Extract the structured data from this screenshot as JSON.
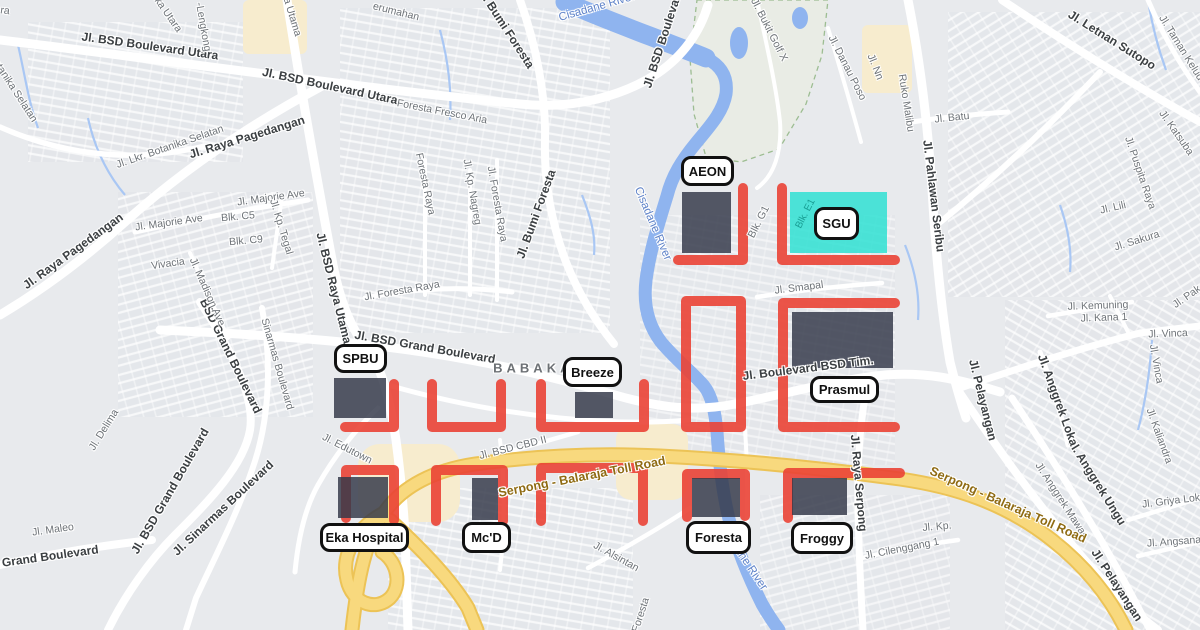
{
  "colors": {
    "annotation_red": "#EA4335",
    "building_fill": "rgba(52,57,74,0.84)",
    "highlight_cyan": "rgba(47,224,210,0.85)",
    "water": "#8FB4EF",
    "toll_road_fill": "#F8D97E",
    "map_background": "#E8EAED",
    "marker_bg": "#FFFFFF",
    "marker_border": "#111111"
  },
  "markers": [
    {
      "id": "aeon",
      "label": "AEON",
      "x": 681,
      "y": 156,
      "w": 53,
      "h": 30
    },
    {
      "id": "sgu",
      "label": "SGU",
      "x": 814,
      "y": 207,
      "w": 45,
      "h": 33
    },
    {
      "id": "spbu",
      "label": "SPBU",
      "x": 334,
      "y": 344,
      "w": 53,
      "h": 29
    },
    {
      "id": "breeze",
      "label": "Breeze",
      "x": 563,
      "y": 357,
      "w": 59,
      "h": 30
    },
    {
      "id": "prasmul",
      "label": "Prasmul",
      "x": 810,
      "y": 376,
      "w": 69,
      "h": 27
    },
    {
      "id": "eka-hospital",
      "label": "Eka Hospital",
      "x": 320,
      "y": 523,
      "w": 89,
      "h": 29
    },
    {
      "id": "mcd",
      "label": "Mc'D",
      "x": 462,
      "y": 522,
      "w": 49,
      "h": 31
    },
    {
      "id": "foresta",
      "label": "Foresta",
      "x": 686,
      "y": 521,
      "w": 65,
      "h": 33
    },
    {
      "id": "froggy",
      "label": "Froggy",
      "x": 791,
      "y": 522,
      "w": 62,
      "h": 32
    }
  ],
  "buildings": [
    {
      "id": "aeon",
      "x": 682,
      "y": 192,
      "w": 49,
      "h": 61
    },
    {
      "id": "prasmul",
      "x": 792,
      "y": 312,
      "w": 101,
      "h": 56
    },
    {
      "id": "spbu",
      "x": 334,
      "y": 378,
      "w": 52,
      "h": 40
    },
    {
      "id": "breeze",
      "x": 575,
      "y": 392,
      "w": 38,
      "h": 26
    },
    {
      "id": "eka-hospital",
      "x": 338,
      "y": 477,
      "w": 50,
      "h": 41
    },
    {
      "id": "mcd",
      "x": 472,
      "y": 478,
      "w": 26,
      "h": 42
    },
    {
      "id": "foresta",
      "x": 692,
      "y": 478,
      "w": 48,
      "h": 39
    },
    {
      "id": "froggy",
      "x": 792,
      "y": 478,
      "w": 55,
      "h": 37
    }
  ],
  "highlight": {
    "id": "sgu-area",
    "x": 790,
    "y": 192,
    "w": 97,
    "h": 61
  },
  "annotations": {
    "red_paths": [
      "M678 260 H743 V188",
      "M782 188 V260 H895",
      "M686 301 H741 V427 H686 Z",
      "M895 303 H783 V427 H895",
      "M345 427 H394 V384",
      "M432 384 V427 H501 V384",
      "M541 384 V427 H644 V384",
      "M346 518 V470 H394 V520",
      "M436 521 V470 H503 V521",
      "M541 521 V468 H643 V521",
      "M687 517 V474 H745 V516",
      "M788 518 V473 H900"
    ]
  },
  "map": {
    "road_labels": [
      {
        "t": "Jl. BSD Boulevard Utara",
        "x": 150,
        "y": 46,
        "r": 8,
        "k": "major"
      },
      {
        "t": "Jl. BSD Boulevard Utara",
        "x": 330,
        "y": 86,
        "r": 12,
        "k": "major"
      },
      {
        "t": "Jl. Raya Pagedangan",
        "x": 247,
        "y": 137,
        "r": -17,
        "k": "major"
      },
      {
        "t": "Jl. Raya Pagedangan",
        "x": 73,
        "y": 251,
        "r": -36,
        "k": "major"
      },
      {
        "t": "Jl. BSD Raya Utama",
        "x": 334,
        "y": 288,
        "r": 76,
        "k": "major"
      },
      {
        "t": "Jl. BSD Grand Boulevard",
        "x": 425,
        "y": 347,
        "r": 10,
        "k": "major"
      },
      {
        "t": "BSD Grand Boulevard",
        "x": 231,
        "y": 356,
        "r": 64,
        "k": "major"
      },
      {
        "t": "Jl. Bumi Foresta",
        "x": 506,
        "y": 28,
        "r": 57,
        "k": "major"
      },
      {
        "t": "Jl. Bumi Foresta",
        "x": 536,
        "y": 214,
        "r": -70,
        "k": "major"
      },
      {
        "t": "Jl. BSD Boulevard",
        "x": 663,
        "y": 38,
        "r": -72,
        "k": "major"
      },
      {
        "t": "Jl. Letnan Sutopo",
        "x": 1112,
        "y": 40,
        "r": 32,
        "k": "major"
      },
      {
        "t": "Jl. Pahlawan Seribu",
        "x": 934,
        "y": 196,
        "r": 83,
        "k": "major"
      },
      {
        "t": "Jl. BSD Grand Boulevard",
        "x": 170,
        "y": 491,
        "r": -60,
        "k": "major"
      },
      {
        "t": "BSD Grand Boulevard",
        "x": 36,
        "y": 558,
        "r": -8,
        "k": "major"
      },
      {
        "t": "Jl. Sinarmas Boulevard",
        "x": 223,
        "y": 508,
        "r": -43,
        "k": "major"
      },
      {
        "t": "Jl. Boulevard BSD Tim.",
        "x": 808,
        "y": 368,
        "r": -7,
        "k": "major"
      },
      {
        "t": "Jl. Pelayangan",
        "x": 983,
        "y": 400,
        "r": 76,
        "k": "major"
      },
      {
        "t": "Jl. Pelayangan",
        "x": 1117,
        "y": 585,
        "r": 57,
        "k": "major"
      },
      {
        "t": "Jl. Anggrek Ungu",
        "x": 1097,
        "y": 482,
        "r": 58,
        "k": "major"
      },
      {
        "t": "Jl. Anggrek Loka",
        "x": 1058,
        "y": 400,
        "r": 70,
        "k": "major"
      },
      {
        "t": "Jl. Raya Serpong",
        "x": 859,
        "y": 483,
        "r": 85,
        "k": "major"
      },
      {
        "t": "Botanika Selatan",
        "x": 13,
        "y": 88,
        "r": 57,
        "k": "minor"
      },
      {
        "t": "ka Utara",
        "x": 168,
        "y": 15,
        "r": 55,
        "k": "minor"
      },
      {
        "t": "ra",
        "x": 5,
        "y": 11,
        "r": 8,
        "k": "minor"
      },
      {
        "t": "a Utama",
        "x": 292,
        "y": 17,
        "r": 73,
        "k": "minor"
      },
      {
        "t": "-Lengkong",
        "x": 203,
        "y": 27,
        "r": 80,
        "k": "minor"
      },
      {
        "t": "erumahan",
        "x": 396,
        "y": 12,
        "r": 14,
        "k": "minor"
      },
      {
        "t": "Jl. Lkr. Botanika Selatan",
        "x": 170,
        "y": 147,
        "r": -19,
        "k": "minor"
      },
      {
        "t": "Jl. Majorie Ave",
        "x": 271,
        "y": 198,
        "r": -8,
        "k": "minor"
      },
      {
        "t": "Jl. Majorie Ave",
        "x": 169,
        "y": 223,
        "r": -8,
        "k": "minor"
      },
      {
        "t": "Blk. C5",
        "x": 238,
        "y": 217,
        "r": -5,
        "k": "minor"
      },
      {
        "t": "Blk. C9",
        "x": 246,
        "y": 241,
        "r": -5,
        "k": "minor"
      },
      {
        "t": "Jl. Kp. Tegal",
        "x": 281,
        "y": 227,
        "r": 73,
        "k": "minor"
      },
      {
        "t": "Vivacia",
        "x": 168,
        "y": 264,
        "r": -8,
        "k": "minor"
      },
      {
        "t": "Jl. Madison Ave",
        "x": 207,
        "y": 292,
        "r": 66,
        "k": "minor"
      },
      {
        "t": "Sinarmas Boulevard",
        "x": 277,
        "y": 364,
        "r": 74,
        "k": "minor"
      },
      {
        "t": "Foresta Fresco Aria",
        "x": 442,
        "y": 112,
        "r": 11,
        "k": "minor"
      },
      {
        "t": "Jl. Foresta Raya",
        "x": 402,
        "y": 291,
        "r": -10,
        "k": "minor"
      },
      {
        "t": "Foresta Raya",
        "x": 425,
        "y": 184,
        "r": 78,
        "k": "minor"
      },
      {
        "t": "Jl. Foresta Raya",
        "x": 497,
        "y": 204,
        "r": 80,
        "k": "minor"
      },
      {
        "t": "Jl. Kp. Nagreg",
        "x": 472,
        "y": 192,
        "r": 80,
        "k": "minor"
      },
      {
        "t": "Jl. Bukit Golf X",
        "x": 769,
        "y": 30,
        "r": 63,
        "k": "minor"
      },
      {
        "t": "Jl. Danau Poso",
        "x": 847,
        "y": 68,
        "r": 63,
        "k": "minor"
      },
      {
        "t": "Jl. Nn",
        "x": 875,
        "y": 67,
        "r": 68,
        "k": "minor"
      },
      {
        "t": "Ruko Malibu",
        "x": 906,
        "y": 103,
        "r": 81,
        "k": "minor"
      },
      {
        "t": "Jl. Batu",
        "x": 952,
        "y": 118,
        "r": -6,
        "k": "minor"
      },
      {
        "t": "Jl. Taman Kelud",
        "x": 1181,
        "y": 48,
        "r": 58,
        "k": "minor"
      },
      {
        "t": "Jl. Katsuba",
        "x": 1176,
        "y": 133,
        "r": 55,
        "k": "minor"
      },
      {
        "t": "Jl. Puspita Raya",
        "x": 1140,
        "y": 173,
        "r": 71,
        "k": "minor"
      },
      {
        "t": "Jl. Lili",
        "x": 1113,
        "y": 208,
        "r": -13,
        "k": "minor"
      },
      {
        "t": "Jl. Sakura",
        "x": 1137,
        "y": 241,
        "r": -17,
        "k": "minor"
      },
      {
        "t": "Jl. Kemuning",
        "x": 1098,
        "y": 306,
        "r": -2,
        "k": "minor"
      },
      {
        "t": "Jl. Kana 1",
        "x": 1104,
        "y": 318,
        "r": -2,
        "k": "minor"
      },
      {
        "t": "Jl. Vinca",
        "x": 1168,
        "y": 334,
        "r": -2,
        "k": "minor"
      },
      {
        "t": "Jl. Vinca",
        "x": 1156,
        "y": 364,
        "r": 80,
        "k": "minor"
      },
      {
        "t": "Jl. Pak",
        "x": 1187,
        "y": 297,
        "r": -35,
        "k": "minor"
      },
      {
        "t": "Jl. Kaliandra",
        "x": 1159,
        "y": 436,
        "r": 70,
        "k": "minor"
      },
      {
        "t": "Jl. Griya Loka",
        "x": 1174,
        "y": 501,
        "r": -7,
        "k": "minor"
      },
      {
        "t": "Jl. Angsana",
        "x": 1174,
        "y": 542,
        "r": -4,
        "k": "minor"
      },
      {
        "t": "Jl. Anggrek Mawar",
        "x": 1061,
        "y": 500,
        "r": 57,
        "k": "minor"
      },
      {
        "t": "Jl. Kp.",
        "x": 937,
        "y": 527,
        "r": -5,
        "k": "minor"
      },
      {
        "t": "Jl. Cilenggang 1",
        "x": 902,
        "y": 549,
        "r": -11,
        "k": "minor"
      },
      {
        "t": "Jl. Edutown",
        "x": 347,
        "y": 449,
        "r": 27,
        "k": "minor"
      },
      {
        "t": "Jl. BSD CBD II",
        "x": 513,
        "y": 448,
        "r": -14,
        "k": "minor"
      },
      {
        "t": "Jl. Alsintan",
        "x": 616,
        "y": 557,
        "r": 29,
        "k": "minor"
      },
      {
        "t": "Foresta",
        "x": 641,
        "y": 615,
        "r": -72,
        "k": "minor"
      },
      {
        "t": "Jl. Smapal",
        "x": 799,
        "y": 288,
        "r": -7,
        "k": "minor"
      },
      {
        "t": "Blk. G1",
        "x": 759,
        "y": 222,
        "r": -63,
        "k": "minor"
      },
      {
        "t": "Jl. Maleo",
        "x": 53,
        "y": 530,
        "r": -8,
        "k": "minor"
      },
      {
        "t": "Jl. Delima",
        "x": 104,
        "y": 430,
        "r": -58,
        "k": "minor"
      },
      {
        "t": "Cisadane River",
        "x": 597,
        "y": 8,
        "r": -16,
        "k": "water"
      },
      {
        "t": "Cisadane River",
        "x": 652,
        "y": 224,
        "r": 67,
        "k": "water"
      },
      {
        "t": "Cisadane River",
        "x": 742,
        "y": 557,
        "r": 56,
        "k": "water"
      },
      {
        "t": "Serpong - Balaraja Toll Road",
        "x": 582,
        "y": 477,
        "r": -11,
        "k": "toll"
      },
      {
        "t": "Serpong - Balaraja Toll Road",
        "x": 1008,
        "y": 505,
        "r": 24,
        "k": "toll"
      },
      {
        "t": "BABAKAN",
        "x": 540,
        "y": 368,
        "r": 0,
        "k": "district"
      },
      {
        "t": "Blk. E1",
        "x": 806,
        "y": 214,
        "r": -63,
        "k": "blk"
      }
    ]
  }
}
